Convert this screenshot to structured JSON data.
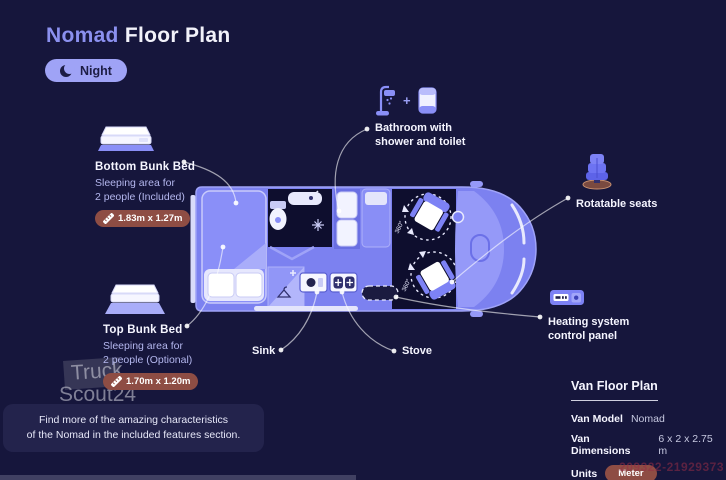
{
  "header": {
    "title_accent": "Nomad",
    "title_rest": "Floor Plan",
    "mode_label": "Night"
  },
  "callouts": {
    "bottom_bunk": {
      "title": "Bottom Bunk Bed",
      "description": "Sleeping area for\n2 people (Included)",
      "dimensions": "1.83m x 1.27m"
    },
    "top_bunk": {
      "title": "Top Bunk Bed",
      "description": "Sleeping area for\n2 people (Optional)",
      "dimensions": "1.70m x 1.20m"
    },
    "bathroom": {
      "label": "Bathroom with\nshower and toilet",
      "plus_sign": "+"
    },
    "rotatable_seats": {
      "label": "Rotatable seats"
    },
    "heating": {
      "label": "Heating system\ncontrol panel"
    },
    "sink": {
      "label": "Sink"
    },
    "stove": {
      "label": "Stove"
    }
  },
  "floor_plan": {
    "seat_rotation_label": "360°"
  },
  "info_panel": {
    "title": "Van Floor Plan",
    "rows": [
      {
        "label": "Van Model",
        "value": "Nomad"
      },
      {
        "label": "Van Dimensions",
        "value": "6 x 2 x 2.75 m"
      },
      {
        "label": "Units",
        "value": "Meter"
      }
    ]
  },
  "note": {
    "text": "Find more of the amazing characteristics\nof the Nomad in the included features section."
  },
  "watermark": {
    "line1": "Truck",
    "line2": "Scout24",
    "ref_number": "209322-21929373"
  },
  "icons": {
    "mode": "moon-icon",
    "dimensions": "ruler-icon",
    "bathroom": [
      "shower-icon",
      "toilet-icon"
    ],
    "rotatable_seats": "swivel-seat-icon",
    "heating": "control-panel-icon",
    "bunk_beds": [
      "bottom-bunk-bed-icon",
      "top-bunk-bed-icon"
    ]
  },
  "colors": {
    "background": "#16163c",
    "accent": "#8b90ef",
    "title_text": "#f2f2fa",
    "night_button_bg": "#9fa3f6",
    "night_button_text": "#1d1d45",
    "van_body": "#7c81f0",
    "van_interior_dark": "#0e0e2e",
    "badge_bg": "#8e4d44",
    "note_bg": "#23234c",
    "description_text": "#b4b7ee",
    "callout_line": "#ffffff"
  }
}
